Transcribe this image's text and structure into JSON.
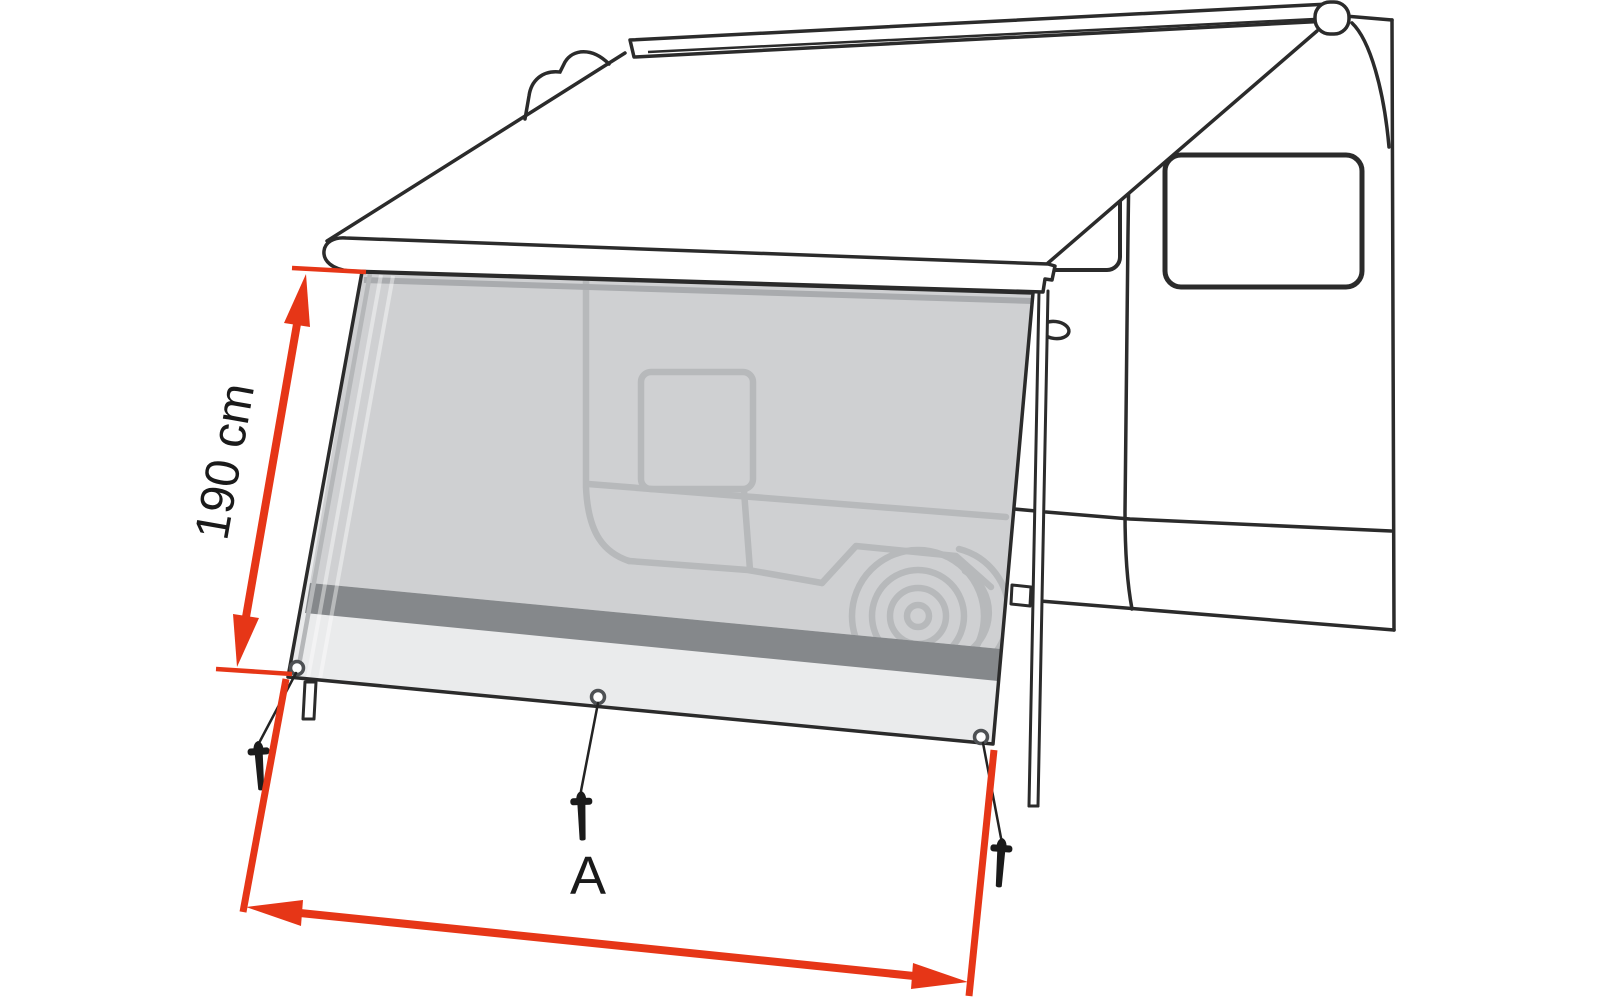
{
  "diagram": {
    "subject": "awning-front-sun-blocker-panel-on-camper-van",
    "height_dimension": {
      "label": "190 cm"
    },
    "width_dimension": {
      "label": "A"
    }
  },
  "colors": {
    "outline": "#2b2b2b",
    "dimension_red": "#e63617",
    "panel_mesh": "#cfd0d2",
    "panel_stripe": "#85888b",
    "panel_skirt": "#eaebec",
    "ghost_line": "#b7b9bb"
  }
}
